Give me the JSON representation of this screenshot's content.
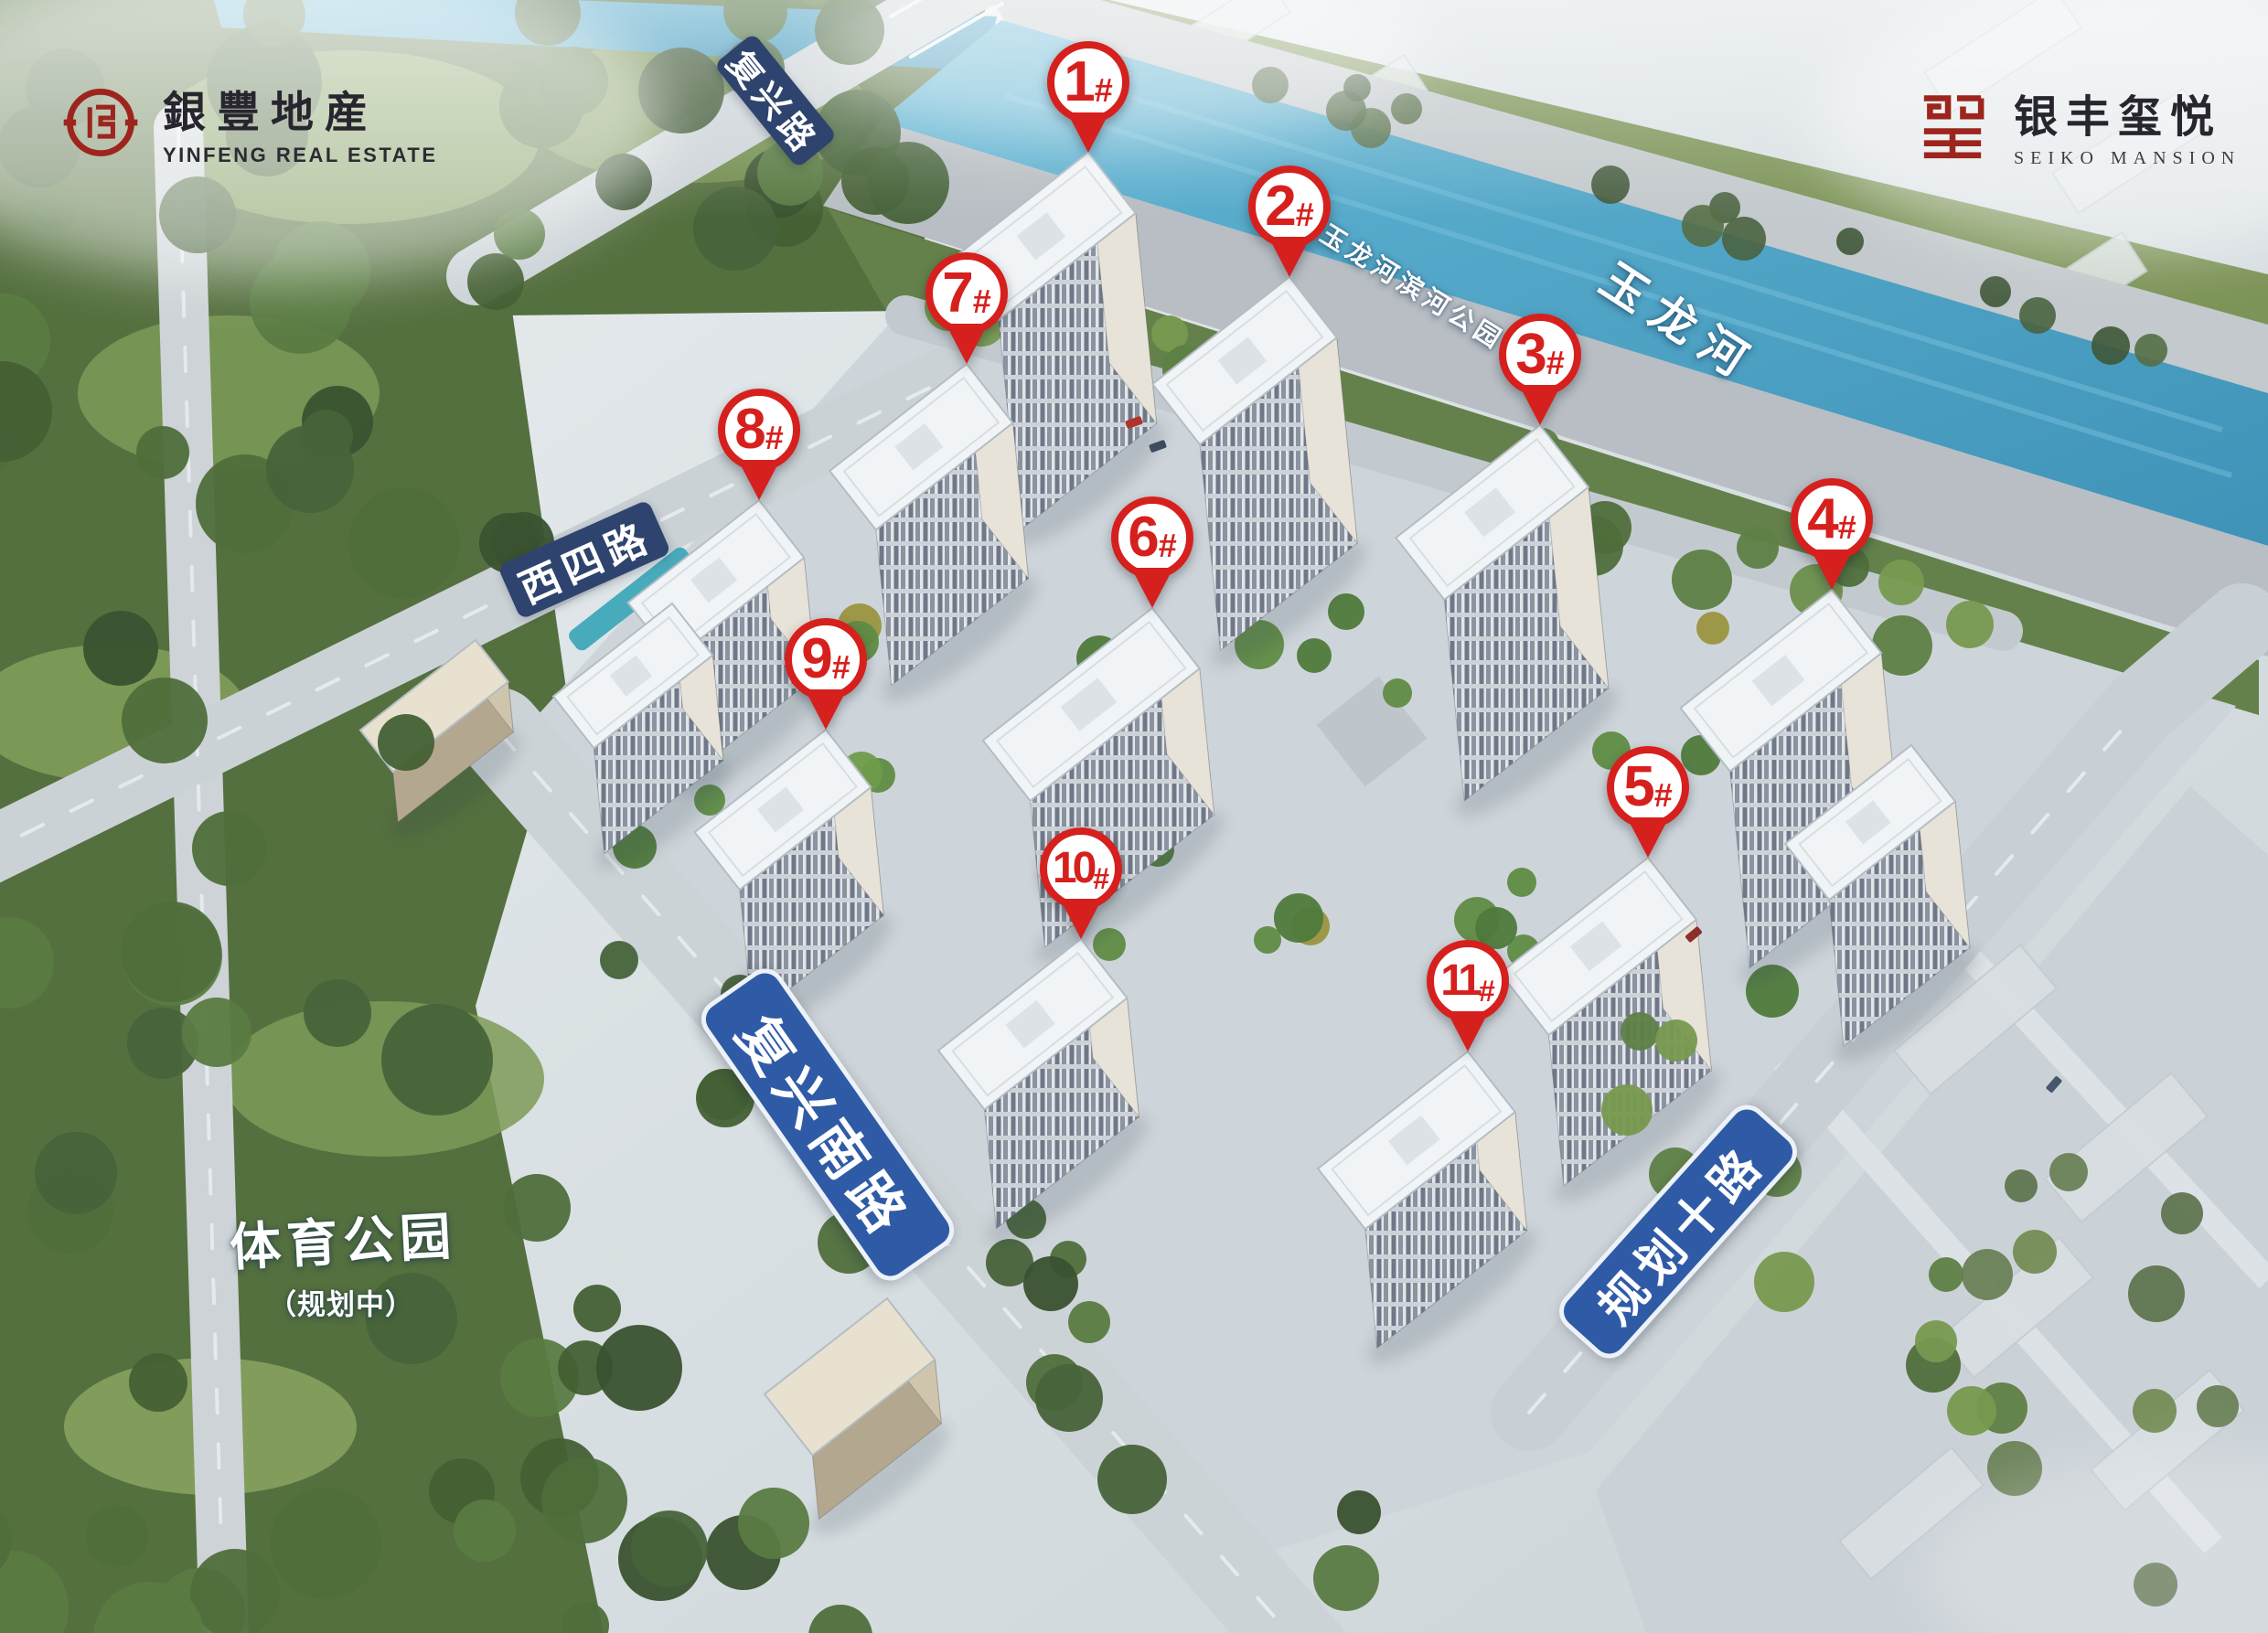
{
  "branding": {
    "developer": {
      "emblem_icon": "yinfeng-circle-seal",
      "name_cn": "銀豐地産",
      "name_en": "YINFENG REAL ESTATE"
    },
    "project": {
      "emblem_icon": "xi-square-seal",
      "name_cn": "银丰玺悦",
      "name_en": "SEIKO MANSION"
    }
  },
  "labels": {
    "river": "玉龙河",
    "riverside_park": "玉龙河滨河公园",
    "sports_park_title": "体育公园",
    "sports_park_subtitle": "（规划中）"
  },
  "roads": [
    {
      "label": "复兴路"
    },
    {
      "label": "西四路"
    },
    {
      "label": "复兴南路"
    },
    {
      "label": "规划十路"
    }
  ],
  "building_markers": [
    {
      "num": "1",
      "hash": "#"
    },
    {
      "num": "2",
      "hash": "#"
    },
    {
      "num": "3",
      "hash": "#"
    },
    {
      "num": "4",
      "hash": "#"
    },
    {
      "num": "5",
      "hash": "#"
    },
    {
      "num": "6",
      "hash": "#"
    },
    {
      "num": "7",
      "hash": "#"
    },
    {
      "num": "8",
      "hash": "#"
    },
    {
      "num": "9",
      "hash": "#"
    },
    {
      "num": "10",
      "hash": "#"
    },
    {
      "num": "11",
      "hash": "#"
    }
  ],
  "colors": {
    "marker_red": "#d6201e",
    "road_sign_navy": "#2e446e",
    "road_sign_blue": "#2f5ba6",
    "river_water": "#4fa9cc",
    "forest_green": "#4c6a3c"
  }
}
